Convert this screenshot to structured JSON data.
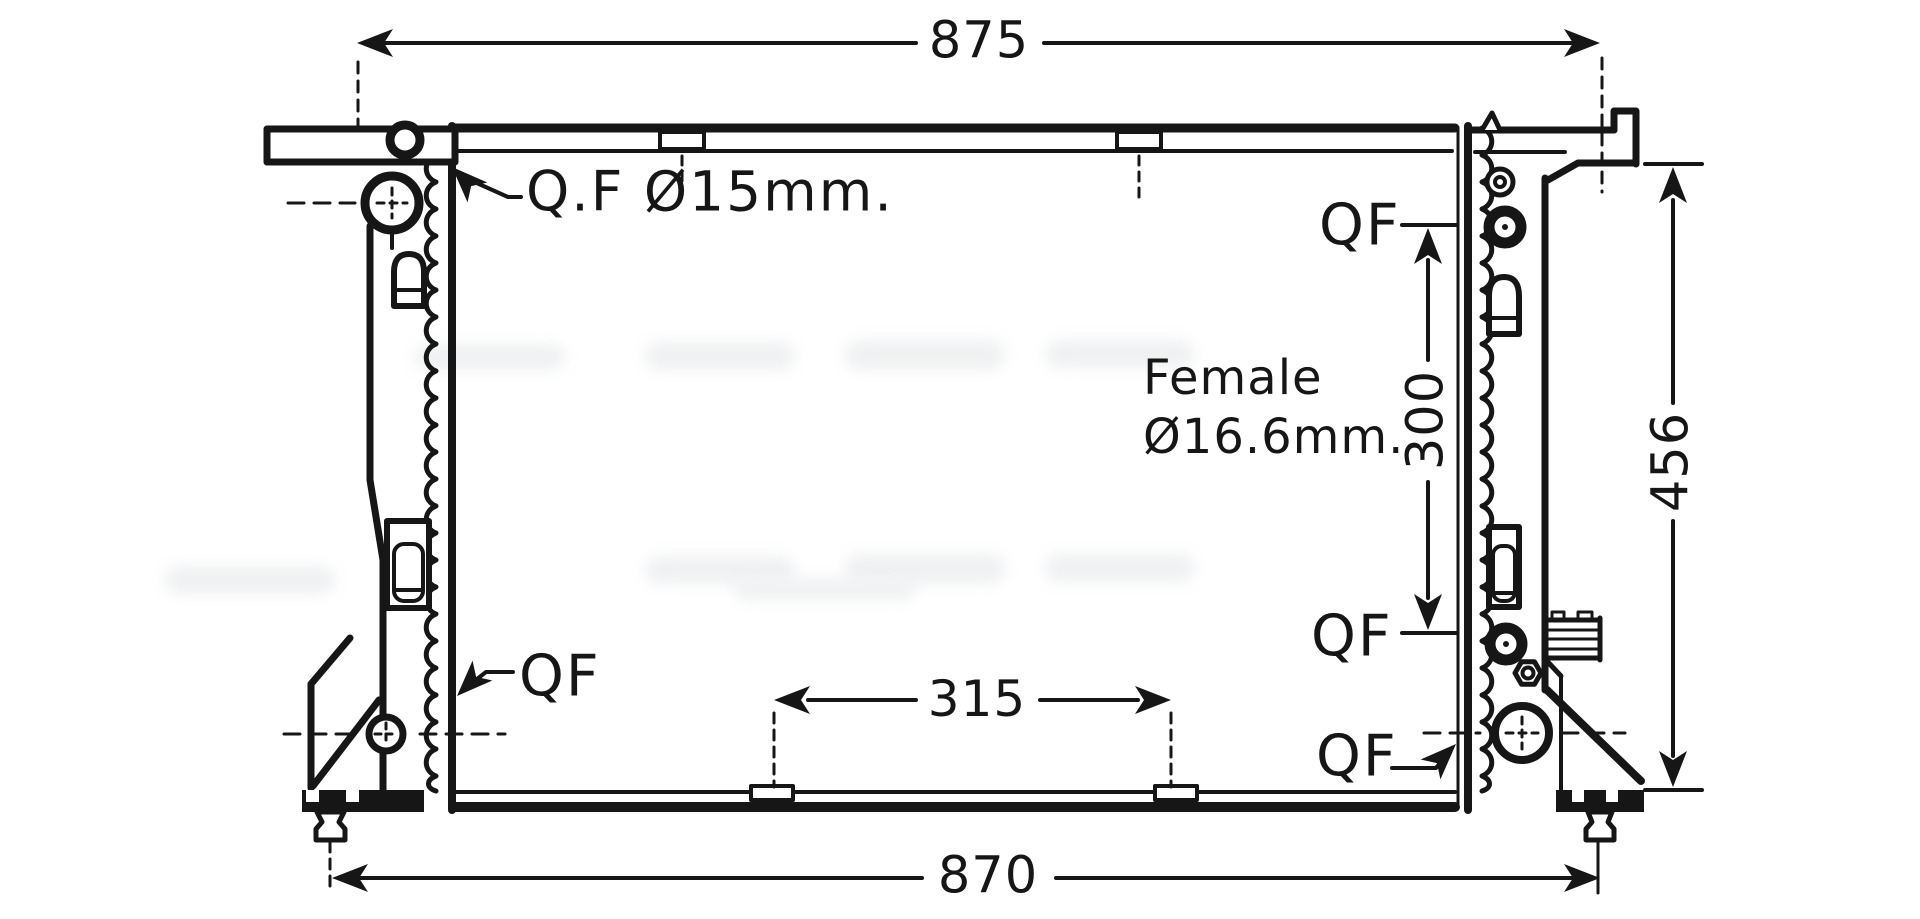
{
  "canvas": {
    "background": "#ffffff",
    "ink": "#161616"
  },
  "callouts": {
    "top_left_port": "Q.F Ø15mm.",
    "bottom_left_port": "QF",
    "female_size_line1": "Female",
    "female_size_line2": "Ø16.6mm.",
    "right_top_port": "QF",
    "right_middle_port": "QF",
    "right_bottom_port": "QF"
  },
  "dimensions": {
    "top_width": "875",
    "bottom_width": "870",
    "overall_height": "456",
    "right_port_spacing": "300",
    "bottom_mount_spacing": "315"
  }
}
